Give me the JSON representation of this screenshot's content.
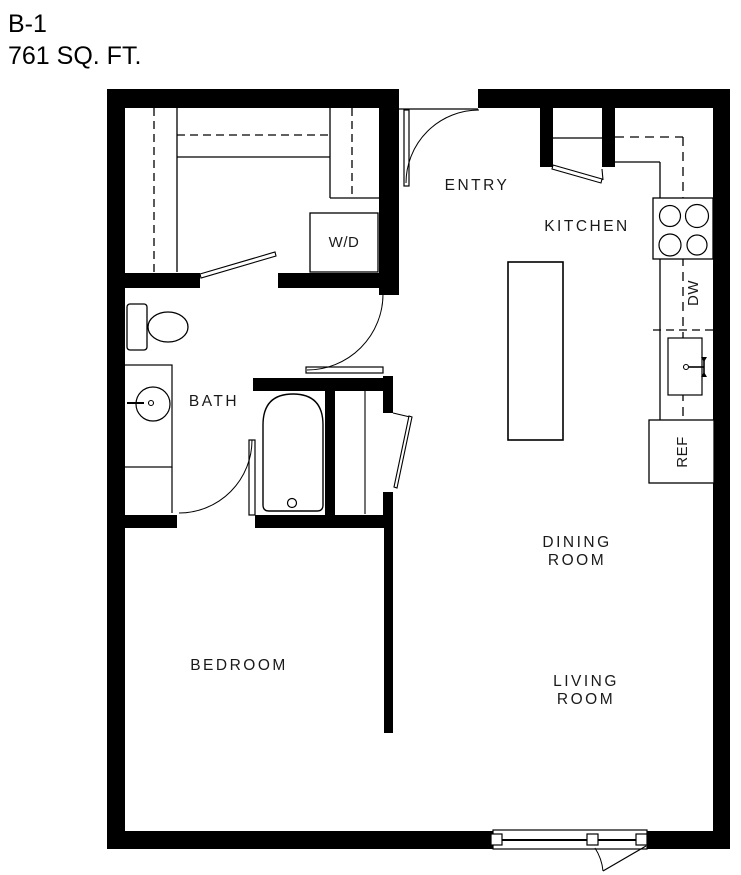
{
  "title": {
    "plan_code": "B-1",
    "area": "761 SQ. FT."
  },
  "labels": {
    "entry": "ENTRY",
    "kitchen": "KITCHEN",
    "bath": "BATH",
    "bedroom": "BEDROOM",
    "dining": "DINING ROOM",
    "living": "LIVING ROOM",
    "washer_dryer": "W/D",
    "dishwasher": "DW",
    "refrigerator": "REF"
  },
  "colors": {
    "walls": "#000000",
    "background": "#ffffff",
    "text": "#1a1a1a",
    "thin_lines": "#000000"
  }
}
